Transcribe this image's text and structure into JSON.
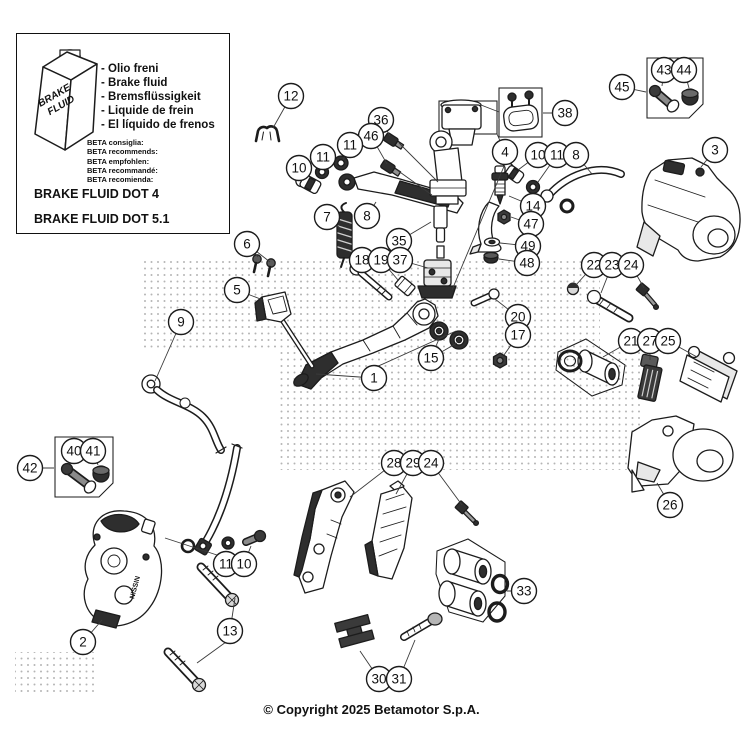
{
  "info_box": {
    "canister_line1": "BRAKE",
    "canister_line2": "FLUID",
    "fluid_names": [
      "- Olio freni",
      "- Brake fluid",
      "- Bremsflüssigkeit",
      "- Liquide de frein",
      "- El líquido de frenos"
    ],
    "beta_lines": [
      "BETA consiglia:",
      "BETA recommends:",
      "BETA empfohlen:",
      "BETA recommandé:",
      "BETA recomienda:"
    ],
    "dot4": "BRAKE FLUID DOT 4",
    "dot51": "BRAKE FLUID DOT 5.1"
  },
  "copyright": "© Copyright 2025 Betamotor S.p.A.",
  "diagram": {
    "caliper_text": "NISSIN",
    "callouts": [
      {
        "n": "12",
        "x": 291,
        "y": 96,
        "lx": 273,
        "ly": 128
      },
      {
        "n": "36",
        "x": 381,
        "y": 120,
        "lx": 390,
        "ly": 136
      },
      {
        "n": "46",
        "x": 371,
        "y": 136,
        "lx": 387,
        "ly": 164
      },
      {
        "n": "11",
        "x": 350,
        "y": 145,
        "lx": 343,
        "ly": 160
      },
      {
        "n": "11",
        "x": 323,
        "y": 157,
        "lx": 322,
        "ly": 166
      },
      {
        "n": "10",
        "x": 299,
        "y": 168,
        "lx": 305,
        "ly": 178
      },
      {
        "n": "7",
        "x": 327,
        "y": 217,
        "lx": 340,
        "ly": 228
      },
      {
        "n": "8",
        "x": 367,
        "y": 216,
        "lx": 376,
        "ly": 202
      },
      {
        "n": "35",
        "x": 399,
        "y": 241,
        "lx": 431,
        "ly": 222
      },
      {
        "n": "18",
        "x": 362,
        "y": 260,
        "lx": 366,
        "ly": 271
      },
      {
        "n": "19",
        "x": 381,
        "y": 260,
        "lx": 398,
        "ly": 280
      },
      {
        "n": "37",
        "x": 400,
        "y": 260,
        "lx": 428,
        "ly": 268
      },
      {
        "n": "38",
        "x": 565,
        "y": 113,
        "lx": 543,
        "ly": 113
      },
      {
        "n": "4",
        "x": 505,
        "y": 152,
        "lx": 497,
        "ly": 134
      },
      {
        "n": "10",
        "x": 538,
        "y": 155,
        "lx": 518,
        "ly": 170
      },
      {
        "n": "11",
        "x": 557,
        "y": 155,
        "lx": 538,
        "ly": 182
      },
      {
        "n": "8",
        "x": 576,
        "y": 155,
        "lx": 592,
        "ly": 174
      },
      {
        "n": "3",
        "x": 715,
        "y": 150,
        "lx": 701,
        "ly": 167
      },
      {
        "n": "45",
        "x": 622,
        "y": 87,
        "lx": 646,
        "ly": 92
      },
      {
        "n": "43",
        "x": 664,
        "y": 70,
        "lx": 662,
        "ly": 86
      },
      {
        "n": "44",
        "x": 684,
        "y": 70,
        "lx": 689,
        "ly": 88
      },
      {
        "n": "14",
        "x": 533,
        "y": 206,
        "lx": 509,
        "ly": 196
      },
      {
        "n": "47",
        "x": 531,
        "y": 224,
        "lx": 511,
        "ly": 217
      },
      {
        "n": "49",
        "x": 528,
        "y": 246,
        "lx": 500,
        "ly": 243
      },
      {
        "n": "48",
        "x": 527,
        "y": 263,
        "lx": 499,
        "ly": 259
      },
      {
        "n": "22",
        "x": 594,
        "y": 265,
        "lx": 576,
        "ly": 285
      },
      {
        "n": "23",
        "x": 612,
        "y": 265,
        "lx": 601,
        "ly": 293
      },
      {
        "n": "24",
        "x": 631,
        "y": 265,
        "lx": 644,
        "ly": 288
      },
      {
        "n": "6",
        "x": 247,
        "y": 244,
        "lx": 258,
        "ly": 257
      },
      {
        "n": "5",
        "x": 237,
        "y": 290,
        "lx": 263,
        "ly": 300
      },
      {
        "n": "9",
        "x": 181,
        "y": 322,
        "lx": 155,
        "ly": 381
      },
      {
        "n": "1",
        "x": 374,
        "y": 378,
        "lx": 316,
        "ly": 374
      },
      {
        "n": "15",
        "x": 431,
        "y": 358,
        "lx": 439,
        "ly": 339
      },
      {
        "n": "20",
        "x": 518,
        "y": 317,
        "lx": 495,
        "ly": 299
      },
      {
        "n": "17",
        "x": 518,
        "y": 335,
        "lx": 504,
        "ly": 355
      },
      {
        "n": "21",
        "x": 631,
        "y": 341,
        "lx": 603,
        "ly": 357
      },
      {
        "n": "27",
        "x": 650,
        "y": 341,
        "lx": 650,
        "ly": 360
      },
      {
        "n": "25",
        "x": 668,
        "y": 341,
        "lx": 697,
        "ly": 357
      },
      {
        "n": "26",
        "x": 670,
        "y": 505,
        "lx": 657,
        "ly": 483
      },
      {
        "n": "42",
        "x": 30,
        "y": 468,
        "lx": 54,
        "ly": 468
      },
      {
        "n": "40",
        "x": 74,
        "y": 451,
        "lx": 70,
        "ly": 464
      },
      {
        "n": "41",
        "x": 93,
        "y": 451,
        "lx": 98,
        "ly": 465
      },
      {
        "n": "11",
        "x": 226,
        "y": 564,
        "lx": 231,
        "ly": 552
      },
      {
        "n": "10",
        "x": 244,
        "y": 564,
        "lx": 251,
        "ly": 546
      },
      {
        "n": "2",
        "x": 83,
        "y": 642,
        "lx": 102,
        "ly": 620
      },
      {
        "n": "13",
        "x": 230,
        "y": 631,
        "lx": 235,
        "ly": 598
      },
      {
        "n": "28",
        "x": 394,
        "y": 463,
        "lx": 350,
        "ly": 497
      },
      {
        "n": "29",
        "x": 413,
        "y": 463,
        "lx": 396,
        "ly": 494
      },
      {
        "n": "24",
        "x": 431,
        "y": 463,
        "lx": 462,
        "ly": 505
      },
      {
        "n": "33",
        "x": 524,
        "y": 591,
        "lx": 507,
        "ly": 591
      },
      {
        "n": "30",
        "x": 379,
        "y": 679,
        "lx": 360,
        "ly": 651
      },
      {
        "n": "31",
        "x": 399,
        "y": 679,
        "lx": 415,
        "ly": 640
      }
    ],
    "extra_leaders": [
      [
        226,
        642,
        197,
        663
      ],
      [
        431,
        358,
        457,
        343
      ],
      [
        247,
        244,
        270,
        262
      ],
      [
        374,
        368,
        456,
        331
      ],
      [
        505,
        164,
        452,
        290
      ],
      [
        499,
        112,
        481,
        105
      ],
      [
        399,
        143,
        438,
        182
      ],
      [
        397,
        170,
        432,
        195
      ],
      [
        220,
        556,
        165,
        538
      ]
    ]
  }
}
